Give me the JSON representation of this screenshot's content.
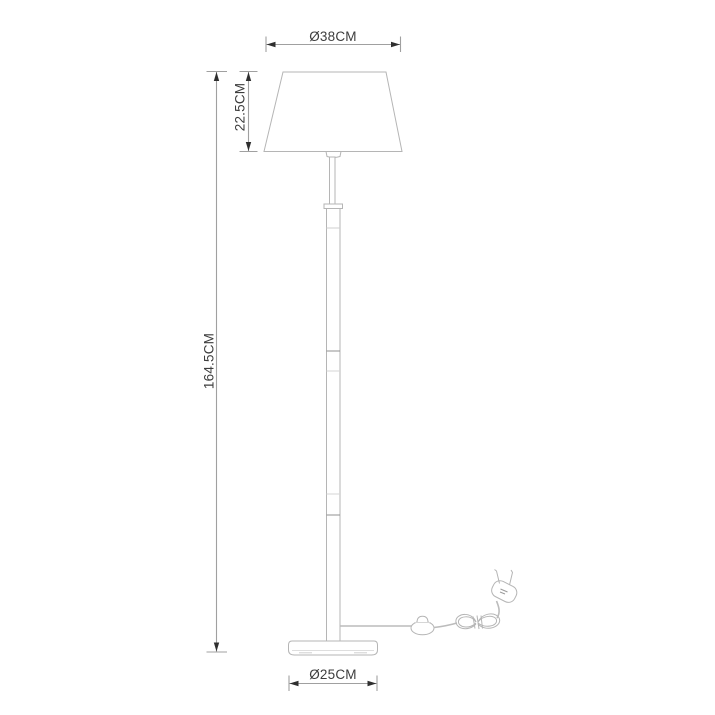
{
  "page": {
    "title": "Floor lamp dimensional drawing",
    "background": "#ffffff"
  },
  "drawing": {
    "type": "product-dimension-diagram",
    "subject": "floor lamp with tapered shade, segmented pole, round base, power cord with inline switch, coiled cord and plug",
    "colors": {
      "outline": "#b5b5b5",
      "outline_dark": "#909090",
      "dimension_line": "#a0a0a0",
      "arrow": "#2f2f2f",
      "label_text": "#3d3d3d",
      "background": "#ffffff"
    },
    "dimensions": {
      "shade_diameter": {
        "label": "Ø38CM",
        "value_cm": 38
      },
      "shade_height": {
        "label": "22.5CM",
        "value_cm": 22.5
      },
      "total_height": {
        "label": "164.5CM",
        "value_cm": 164.5
      },
      "base_diameter": {
        "label": "Ø25CM",
        "value_cm": 25
      }
    },
    "parts": [
      "lampshade",
      "shade-fitting",
      "stem-rod",
      "pole",
      "base",
      "power-cord",
      "inline-switch",
      "coiled-cord",
      "power-plug"
    ]
  }
}
